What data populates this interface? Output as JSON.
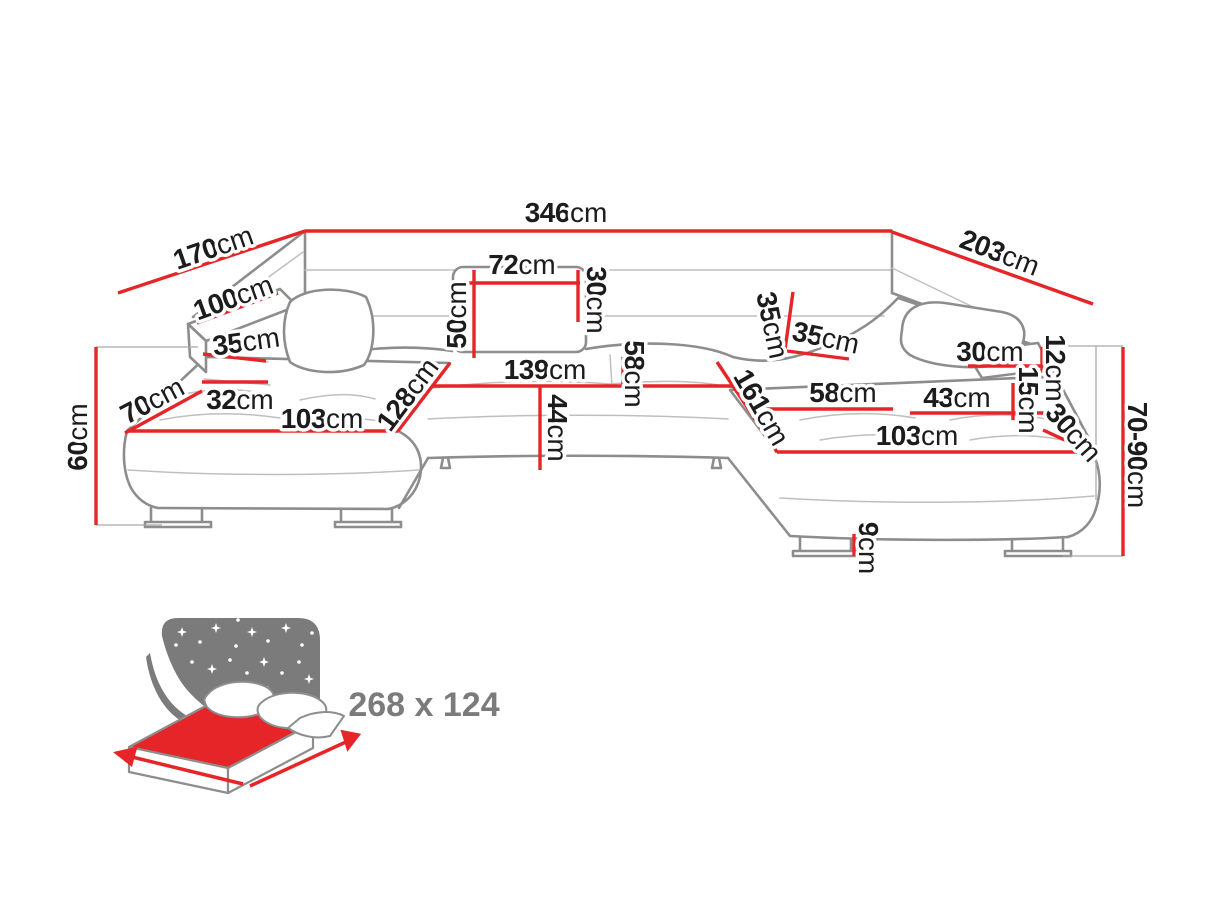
{
  "colors": {
    "dimension_red": "#e52528",
    "outline_gray": "#8d8d8d",
    "seam_gray": "#bfbfbf",
    "label_black": "#1c1c1c",
    "icon_gray": "#7b7b7b"
  },
  "diagram": {
    "dimensions": [
      {
        "id": "back-width",
        "value": "346",
        "unit": "cm"
      },
      {
        "id": "left-side-depth",
        "value": "170",
        "unit": "cm"
      },
      {
        "id": "right-side-depth",
        "value": "203",
        "unit": "cm"
      },
      {
        "id": "left-arm-length",
        "value": "100",
        "unit": "cm"
      },
      {
        "id": "left-arm-front-width",
        "value": "35",
        "unit": "cm"
      },
      {
        "id": "left-chaise-front-depth",
        "value": "70",
        "unit": "cm"
      },
      {
        "id": "left-arm-seat-gap",
        "value": "32",
        "unit": "cm"
      },
      {
        "id": "left-chaise-length",
        "value": "103",
        "unit": "cm"
      },
      {
        "id": "left-seat-diagonal",
        "value": "128",
        "unit": "cm"
      },
      {
        "id": "headrest-total-height",
        "value": "50",
        "unit": "cm"
      },
      {
        "id": "headrest-width",
        "value": "72",
        "unit": "cm"
      },
      {
        "id": "headrest-height",
        "value": "30",
        "unit": "cm"
      },
      {
        "id": "center-seat-width",
        "value": "139",
        "unit": "cm"
      },
      {
        "id": "center-backrest-height",
        "value": "58",
        "unit": "cm"
      },
      {
        "id": "seat-front-height",
        "value": "44",
        "unit": "cm"
      },
      {
        "id": "right-backrest-height",
        "value": "35",
        "unit": "cm"
      },
      {
        "id": "right-backrest-width",
        "value": "35",
        "unit": "cm"
      },
      {
        "id": "right-chaise-diagonal",
        "value": "161",
        "unit": "cm"
      },
      {
        "id": "right-seat-width",
        "value": "58",
        "unit": "cm"
      },
      {
        "id": "right-arm-top-width",
        "value": "30",
        "unit": "cm"
      },
      {
        "id": "right-arm-thickness",
        "value": "12",
        "unit": "cm"
      },
      {
        "id": "right-arm-seat-gap",
        "value": "15",
        "unit": "cm"
      },
      {
        "id": "right-seat-front-width",
        "value": "43",
        "unit": "cm"
      },
      {
        "id": "right-arm-end-width",
        "value": "30",
        "unit": "cm"
      },
      {
        "id": "right-chaise-length",
        "value": "103",
        "unit": "cm"
      },
      {
        "id": "overall-height",
        "value": "70-90",
        "unit": "cm"
      },
      {
        "id": "leg-height",
        "value": "9",
        "unit": "cm"
      },
      {
        "id": "left-side-height",
        "value": "60",
        "unit": "cm"
      }
    ]
  },
  "bed_icon": {
    "size_label": "268 x 124"
  }
}
